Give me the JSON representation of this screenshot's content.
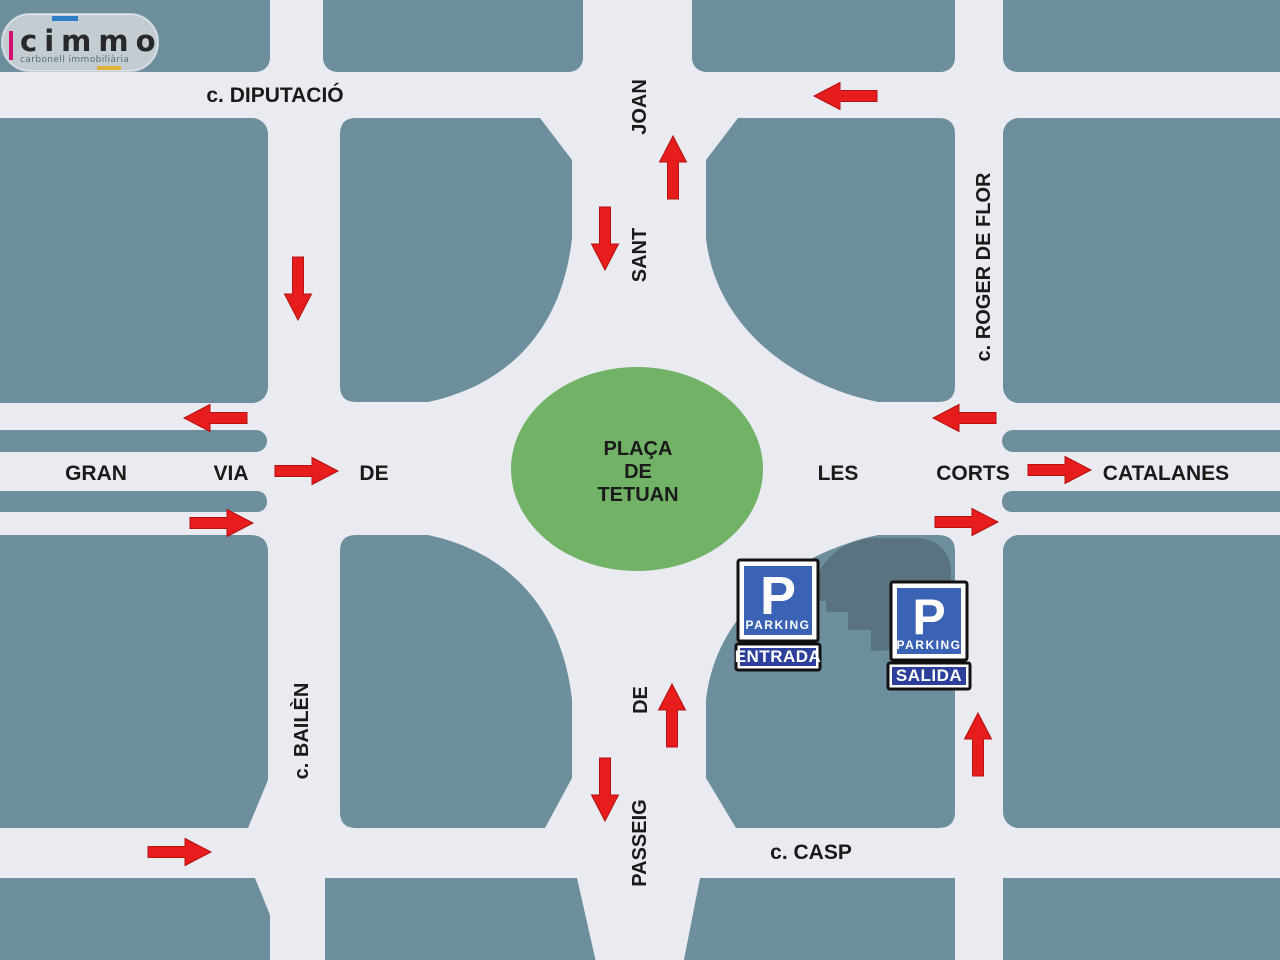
{
  "logo": {
    "brand": "cimmo",
    "tagline": "carbonell immobiliària"
  },
  "map": {
    "colors": {
      "street_bg": "#e9ebf1",
      "block_teal": "#6d8f9d",
      "building": "#5a7381",
      "plaza_green": "#72b266",
      "arrow_red": "#e61c1d",
      "arrow_dark": "#b51212",
      "label": "#1a1a1a",
      "sign_blue": "#3b63b5",
      "sign_bar": "#2c3f9a",
      "sign_frame": "#ffffff",
      "sign_border": "#111111",
      "logo_bg": "#c3ccd1",
      "logo_text": "#26282b",
      "logo_tagline": "#5d6e77",
      "logo_pink": "#d40f72",
      "logo_blue": "#2f7dc2",
      "logo_yellow": "#ddb13a"
    },
    "plaza": {
      "line1": "PLAÇA",
      "line2": "DE",
      "line3": "TETUAN"
    },
    "streets": {
      "diputacio": "c. DIPUTACIÓ",
      "casp": "c. CASP",
      "roger_de_flor": "c. ROGER DE FLOR",
      "bailen": "c. BAILÈN",
      "sant_joan": {
        "joan": "JOAN",
        "sant": "SANT"
      },
      "passeig": {
        "de": "DE",
        "passeig": "PASSEIG"
      },
      "gran_via": {
        "gran": "GRAN",
        "via": "VIA",
        "de": "DE",
        "les": "LES",
        "corts": "CORTS",
        "catalanes": "CATALANES"
      }
    },
    "signs": {
      "p_symbol": "P",
      "parking_label": "PARKING",
      "entrada": "ENTRADA",
      "salida": "SALIDA"
    },
    "arrows": [
      {
        "name": "bailen-southbound",
        "x": 298,
        "y": 257,
        "angle": 90
      },
      {
        "name": "sant-joan-southbound",
        "x": 605,
        "y": 207,
        "angle": 90
      },
      {
        "name": "sant-joan-northbound",
        "x": 673,
        "y": 199,
        "angle": -90
      },
      {
        "name": "diputacio-westbound",
        "x": 877,
        "y": 96,
        "angle": 180
      },
      {
        "name": "gran-via-west-upper",
        "x": 247,
        "y": 418,
        "angle": 180
      },
      {
        "name": "gran-via-west-center",
        "x": 275,
        "y": 471,
        "angle": 0
      },
      {
        "name": "gran-via-west-lower",
        "x": 190,
        "y": 523,
        "angle": 0
      },
      {
        "name": "gran-via-east-upper",
        "x": 996,
        "y": 418,
        "angle": 180
      },
      {
        "name": "gran-via-east-center",
        "x": 1028,
        "y": 470,
        "angle": 0
      },
      {
        "name": "gran-via-east-lower",
        "x": 935,
        "y": 522,
        "angle": 0
      },
      {
        "name": "passeig-northbound",
        "x": 672,
        "y": 747,
        "angle": -90
      },
      {
        "name": "passeig-southbound",
        "x": 605,
        "y": 758,
        "angle": 90
      },
      {
        "name": "roger-de-flor-northbound",
        "x": 978,
        "y": 776,
        "angle": -90
      },
      {
        "name": "casp-eastbound",
        "x": 148,
        "y": 852,
        "angle": 0
      }
    ]
  }
}
